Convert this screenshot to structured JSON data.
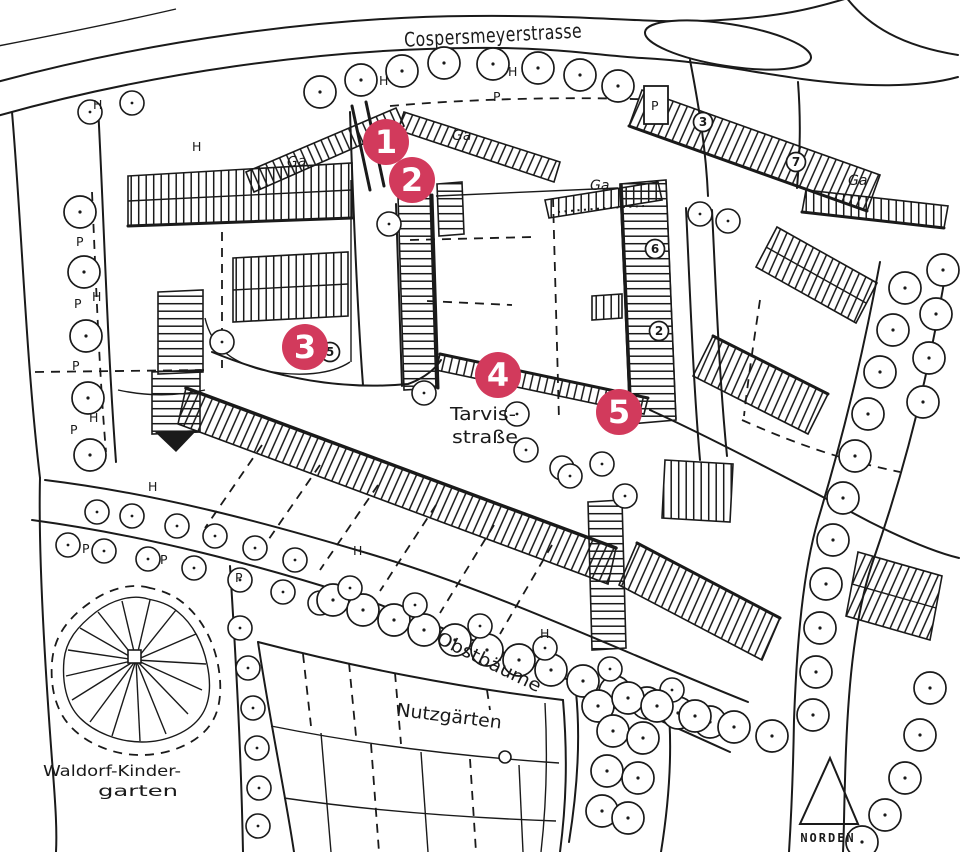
{
  "map": {
    "streets": {
      "main_street": "Cospersmeyerstrasse",
      "tarvis_line1": "Tarvis-",
      "tarvis_line2": "straße"
    },
    "areas": {
      "orchard": "Obstbäume",
      "allotments": "Nutzgärten",
      "kindergarten_line1": "Waldorf-Kinder-",
      "kindergarten_line2": "garten"
    },
    "compass": {
      "label": "NORDEN"
    },
    "markers": [
      {
        "label": "1"
      },
      {
        "label": "2"
      },
      {
        "label": "3"
      },
      {
        "label": "4"
      },
      {
        "label": "5"
      }
    ],
    "letters": {
      "parking": "P",
      "h": "H",
      "garage": "Ga"
    },
    "building_numbers": {
      "n2": "2",
      "n3": "3",
      "n5": "5",
      "n6": "6",
      "n7": "7"
    },
    "colors": {
      "marker_red": "#d23a5c",
      "ink": "#1a1a1a",
      "paper": "#ffffff"
    }
  }
}
